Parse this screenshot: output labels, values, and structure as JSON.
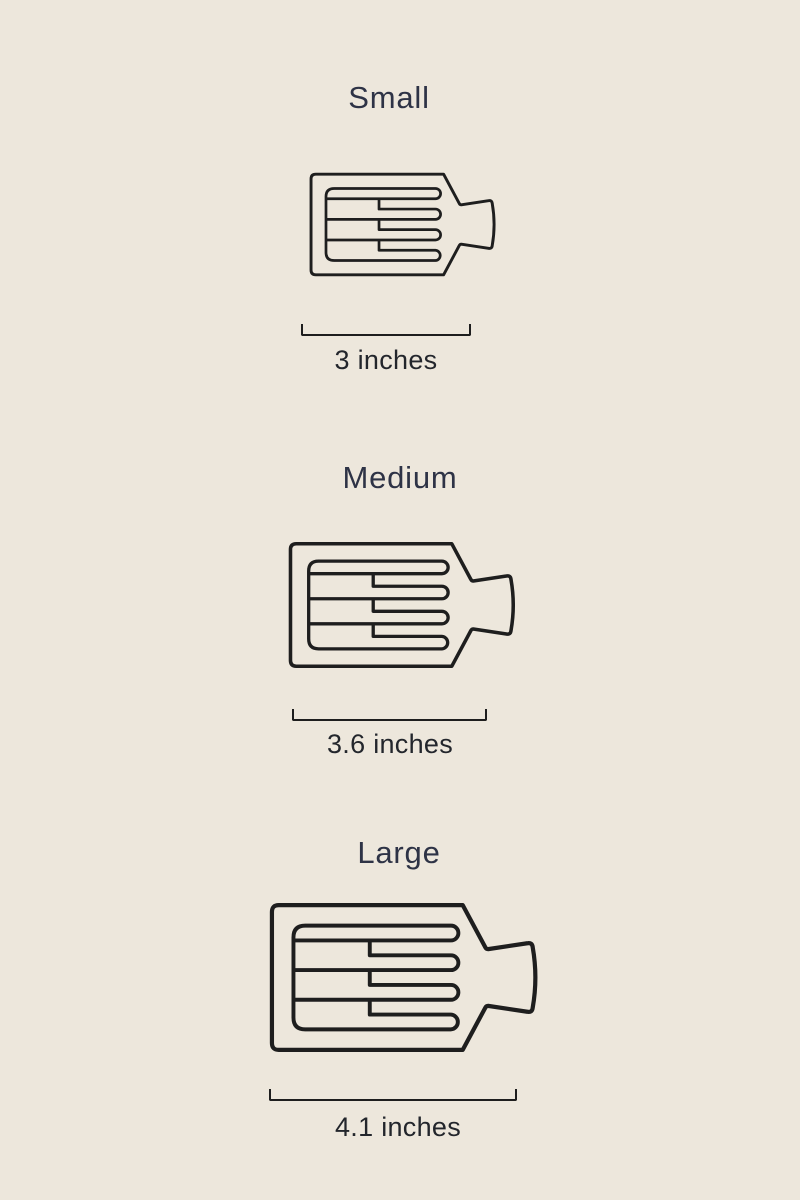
{
  "page": {
    "background_color": "#EDE7DC",
    "title_color": "#2E3346",
    "label_color": "#23262C",
    "illustration_line_color": "#1E1E1E",
    "illustration": "claw-clip-top-view"
  },
  "sizes": [
    {
      "label": "Small",
      "measurement": "3 inches"
    },
    {
      "label": "Medium",
      "measurement": "3.6 inches"
    },
    {
      "label": "Large",
      "measurement": "4.1 inches"
    }
  ]
}
